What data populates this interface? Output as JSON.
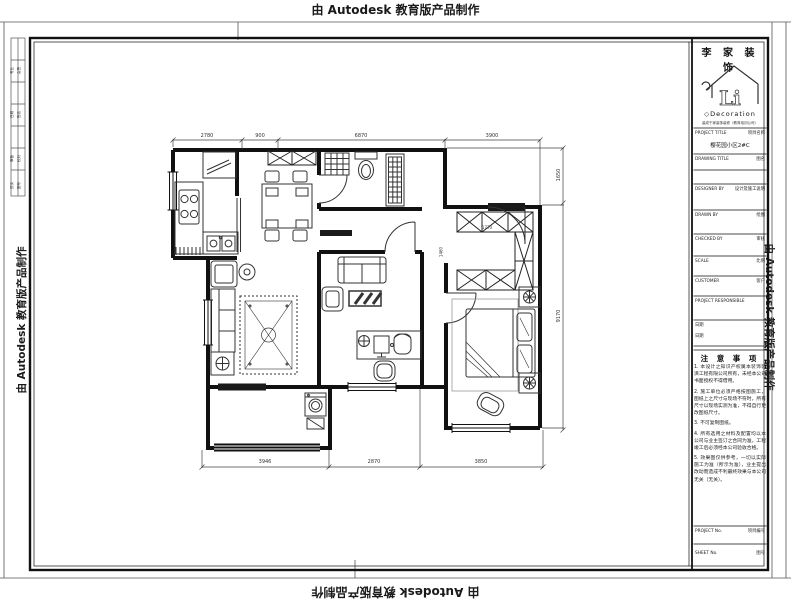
{
  "watermark": {
    "text": "由 Autodesk 教育版产品制作"
  },
  "titleblock": {
    "company": "李 家 装 饰",
    "logo_text": "Li",
    "brand_sub": "◇Decoration",
    "tagline": "装成千家装饰装修（教育培训公司）",
    "rows": {
      "project_title_label": "PROJECT TITLE",
      "project_title_cn": "项目名称",
      "project_title_value": "樱花园小区2#C",
      "drawing_title_label": "DRAWING TITLE",
      "drawing_title_cn": "图名",
      "designer_label": "DESIGNER BY",
      "designer_cn": "设计及施工说明",
      "drawn_label": "DRAWN BY",
      "drawn_cn": "绘图",
      "checked_label": "CHECKED BY",
      "checked_cn": "审核",
      "scale_label": "SCALE",
      "scale_cn": "比例",
      "customer_label": "CUSTOMER",
      "customer_cn": "客户",
      "responsible_label": "PROJECT RESPONSIBLE",
      "date1": "日期",
      "date2": "日期",
      "project_no_label": "PROJECT No.",
      "project_no_cn": "项目编号",
      "sheet_no_label": "SHEET No.",
      "sheet_no_cn": "图号"
    },
    "notes": {
      "title": "注 意 事 项",
      "items": [
        "1. 本设计之知识产权属本装饰装潢工程有限公司所有，未经本公司书面授权不得借用。",
        "2. 施工单位必须严格按图施工，图纸上之尺寸与现场不符时，所有尺寸以现场实测为准，不得自行更改图纸尺寸。",
        "3. 不可复制图纸。",
        "4. 所有选用之材料及配置均以本公司与业主签订之合同为准，工程竣工后必须经本公司验收合格。",
        "5. 效果图仅供参考，一切以实际施工为准（所示为准），业主提出改动而造成不利最终效果与本公司无关（无关）。"
      ]
    }
  },
  "signoff": [
    [
      "专业",
      "会签"
    ],
    [
      "日期",
      "签名"
    ],
    [
      "审核",
      "校对"
    ],
    [
      "页次",
      "图号"
    ]
  ],
  "dims": {
    "top": [
      "2780",
      "900",
      "6870",
      "3900"
    ],
    "bottom": [
      "3946",
      "2870",
      "3850"
    ],
    "right": [
      "1650",
      "9170"
    ],
    "inner": [
      "1770",
      "1460"
    ]
  }
}
